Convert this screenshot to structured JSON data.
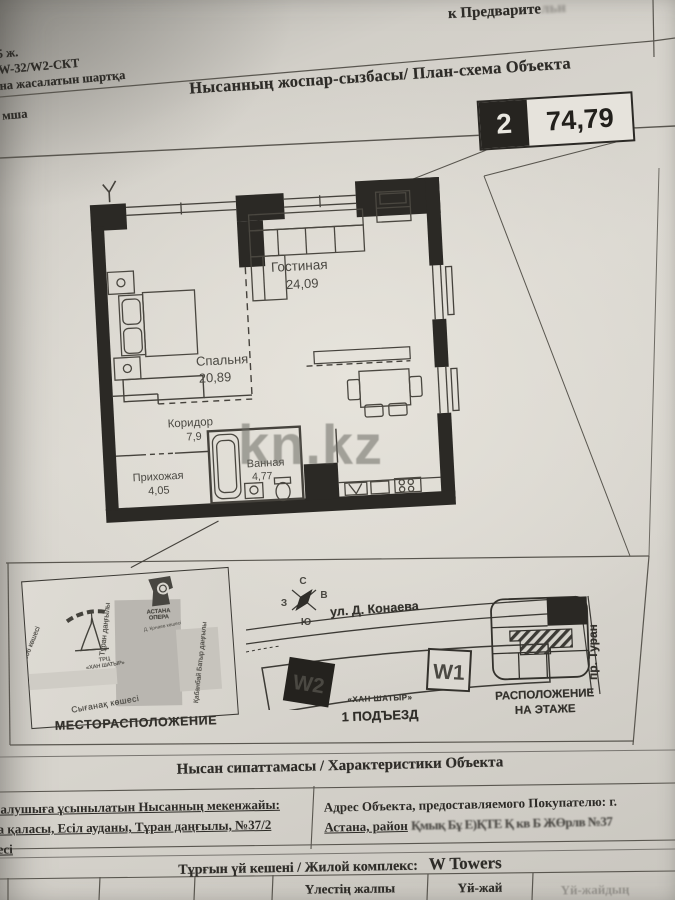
{
  "page": {
    "top_ref": "к Предварите",
    "top_ref_faded": "льн",
    "corner_notes": [
      "5 ж.",
      "W-32/W2-СКТ",
      "на жасалатын шартқа",
      "мша"
    ],
    "title": "Нысанның жоспар-сызбасы/ План-схема Объекта",
    "badge": {
      "number": "2",
      "area": "74,79"
    }
  },
  "plan": {
    "rooms": [
      {
        "name": "Гостиная",
        "area": "24,09"
      },
      {
        "name": "Спальня",
        "area": "20,89"
      },
      {
        "name": "Коридор",
        "area": "7,9"
      },
      {
        "name": "Прихожая",
        "area": "4,05"
      },
      {
        "name": "Ванная",
        "area": "4,77"
      }
    ]
  },
  "watermark": "kn.kz",
  "location": {
    "label": "МЕСТОРАСПОЛОЖЕНИЕ",
    "street_left": "306 көшесі",
    "street_turan": "Тұран даңғылы",
    "street_kabanbay": "Қабанбай Батыр даңғылы",
    "street_syganak": "Сығанақ көшесі",
    "street_konaev_small": "Д. Қонаев көшесі",
    "mall_prefix": "ТРЦ",
    "mall_name": "«ХАН ШАТЫР»",
    "opera_line1": "АСТАНА",
    "opera_line2": "ОПЕРА"
  },
  "entrance": {
    "label": "1 ПОДЪЕЗД",
    "street": "ул. Д. Конаева",
    "prospekt": "пр. Туран",
    "note": "«ХАН ШАТЫР»",
    "tower_w2": "W2",
    "tower_w1": "W1",
    "compass": {
      "n": "С",
      "e": "В",
      "s": "Ю",
      "w": "З"
    }
  },
  "floor_position": {
    "label1": "РАСПОЛОЖЕНИЕ",
    "label2": "НА ЭТАЖЕ"
  },
  "characteristics": {
    "title": "Нысан сипаттамасы / Характеристики Объекта",
    "address_kz_1": "п алушыға ұсынылатын Нысанның мекенжайы:",
    "address_kz_2": "на қаласы, Есіл ауданы, Тұран даңғылы, №37/2",
    "address_kz_3": "кесі",
    "address_ru_1": "Адрес Объекта, предоставляемого Покупателю: г.",
    "address_ru_2": "Астана, район",
    "address_ru_smudge": "Қмық Бұ Е)ҚТЕ Қ кв Б ЖӨрлв  №37",
    "complex_label": "Тұрғын үй кешені / Жилой комплекс:",
    "complex_name": "W Towers",
    "table_headers": [
      "Үлестің жалпы",
      "Үй-жай",
      "Үй-жайдың"
    ]
  }
}
